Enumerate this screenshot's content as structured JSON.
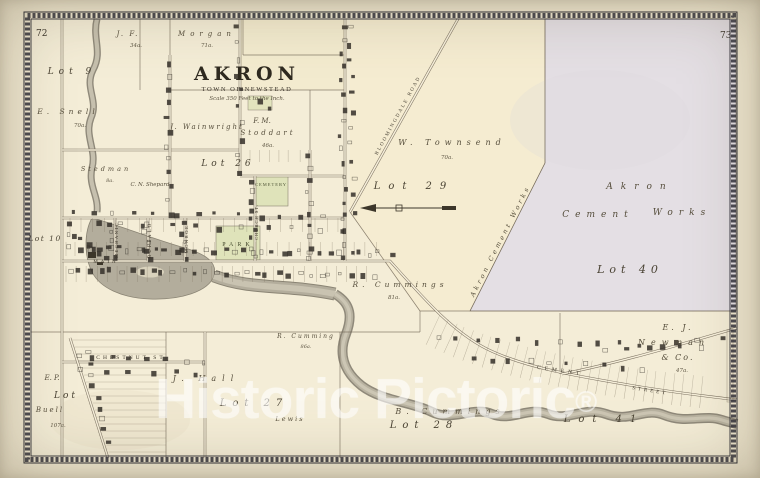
{
  "page": {
    "left": "72",
    "right": "73"
  },
  "title": {
    "name": "AKRON",
    "subtitle": "TOWN OF NEWSTEAD",
    "scale": "Scale 350 Feet to the Inch."
  },
  "watermark": {
    "text": "Historic Pictoric",
    "symbol": "®"
  },
  "lots": {
    "lot9": "Lot 9",
    "lot10": "Lot 10",
    "lot26": "Lot 26",
    "lot27": "Lot 27",
    "lot28": "Lot 28",
    "lot29": "Lot 29",
    "lot40": "Lot 40",
    "lot41": "Lot 41"
  },
  "owners": {
    "jf": "J. F.",
    "jf_acres": "34a.",
    "morgan": "Morgan",
    "morgan_acres": "71a.",
    "snell": "E. Snell",
    "snell_acres": "70a.",
    "wainwright": "J. Wainwright",
    "stoddart_first": "F. M.",
    "stoddart_last": "Stoddart",
    "stoddart_acres": "46a.",
    "stedman": "Stedman",
    "stedman_acres": "8a.",
    "shepard": "C. N. Shepard",
    "townsend": "W. Townsend",
    "townsend_acres": "70a.",
    "cement_works_1": "Akron",
    "cement_works_2": "Cement",
    "cement_works_3": "Works",
    "cement_works_diagonal": "Akron Cement Works",
    "r_cummings": "R. Cummings",
    "r_cummings_acres": "81a.",
    "r_cumming_2": "R. Cumming",
    "r_cumming_2_acres": "86a.",
    "b_cummings": "B. Cummings",
    "newman_1": "E. J.",
    "newman_2": "Newman",
    "newman_3": "& Co.",
    "newman_acres": "47a.",
    "hall": "J. Hall",
    "lewis": "Lewis",
    "buell_initials": "E. P.",
    "buell_lot_word": "Lot",
    "buell_name": "Buell",
    "buell_acres": "107a."
  },
  "streets": {
    "main": "MAIN",
    "buffalo": "BUFFALO",
    "mechanic": "MECHANIC",
    "monroe": "MONROE",
    "church": "CHURCH ST.",
    "chestnut": "CHESTNUT ST.",
    "cement": "CEMENT",
    "street": "STREET",
    "bloomingdale": "BLOOMINGDALE ROAD"
  },
  "places": {
    "park": "PARK",
    "cemetery": "CEMETERY"
  },
  "colors": {
    "paper": "#f1e9d2",
    "map_cream": "#f4edd7",
    "lot40_lavender": "#e4dfe4",
    "park_green": "#dfe3ba",
    "water": "#b3ad9c",
    "ink": "#46402f",
    "border": "#2b2b33",
    "watermark": "rgba(255,255,255,0.55)"
  }
}
